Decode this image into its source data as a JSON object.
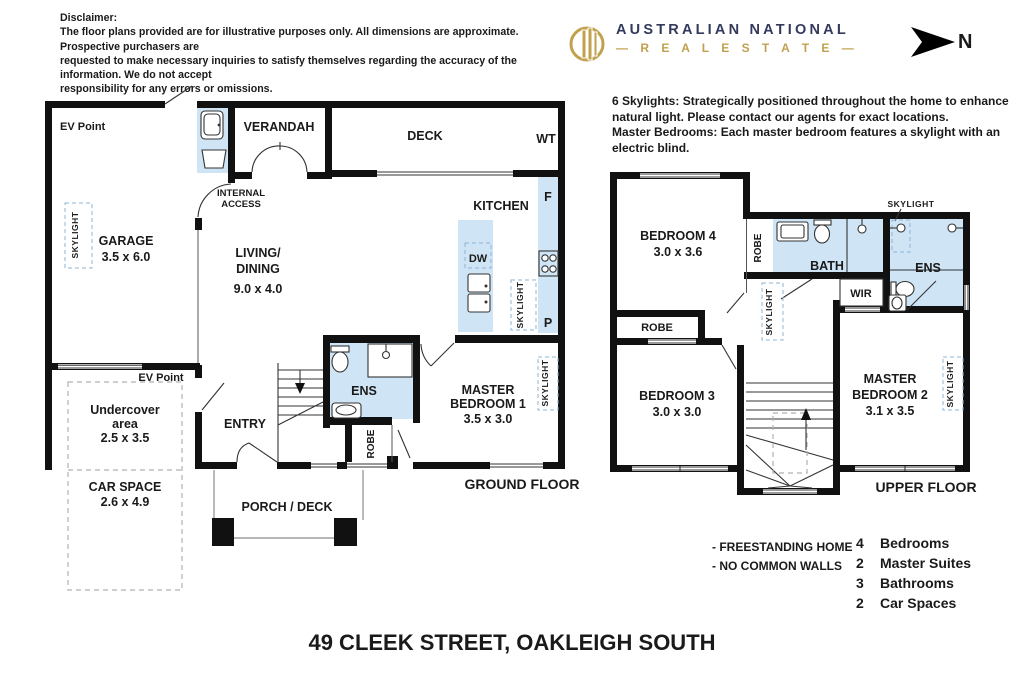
{
  "header": {
    "disclaimer_title": "Disclaimer:",
    "disclaimer_lines": [
      "The floor plans provided are for illustrative purposes only. All dimensions are approximate. Prospective purchasers are",
      "requested to make necessary inquiries to satisfy themselves regarding the accuracy of the information. We do not accept",
      "responsibility for any errors or omissions."
    ],
    "brand": {
      "name": "AUSTRALIAN NATIONAL",
      "tagline": "R E A L   E S T A T E",
      "dash": "—"
    },
    "north_label": "N"
  },
  "notes": {
    "skylights_1": "6 Skylights: Strategically positioned throughout the home to enhance",
    "skylights_2": "natural light. Please contact our agents for exact locations.",
    "skylights_3": "Master Bedrooms: Each master bedroom features a skylight with an",
    "skylights_4": "electric blind."
  },
  "labels": {
    "skylight": "SKYLIGHT",
    "robe": "ROBE",
    "ens": "ENS",
    "ev_point": "EV Point",
    "verandah": "VERANDAH",
    "deck": "DECK",
    "wt": "WT",
    "internal_access_1": "INTERNAL",
    "internal_access_2": "ACCESS",
    "kitchen": "KITCHEN",
    "fridge": "F",
    "pantry": "P",
    "dishwasher": "DW",
    "garage": "GARAGE",
    "garage_dims": "3.5 x 6.0",
    "living_1": "LIVING/",
    "living_2": "DINING",
    "living_dims": "9.0 x 4.0",
    "undercover_1": "Undercover",
    "undercover_2": "area",
    "undercover_dims": "2.5 x 3.5",
    "car_space": "CAR SPACE",
    "car_space_dims": "2.6 x 4.9",
    "entry": "ENTRY",
    "porch": "PORCH / DECK",
    "master1_1": "MASTER",
    "master1_2": "BEDROOM 1",
    "master1_dims": "3.5 x 3.0",
    "ground_floor": "GROUND FLOOR",
    "bedroom4": "BEDROOM 4",
    "bedroom4_dims": "3.0 x 3.6",
    "bedroom3": "BEDROOM 3",
    "bedroom3_dims": "3.0 x 3.0",
    "master2_1": "MASTER",
    "master2_2": "BEDROOM 2",
    "master2_dims": "3.1 x 3.5",
    "bath": "BATH",
    "wir": "WIR",
    "upper_floor": "UPPER FLOOR"
  },
  "footer": {
    "features": [
      "- FREESTANDING HOME",
      "- NO COMMON WALLS"
    ],
    "stats": [
      {
        "num": "4",
        "label": "Bedrooms"
      },
      {
        "num": "2",
        "label": "Master Suites"
      },
      {
        "num": "3",
        "label": "Bathrooms"
      },
      {
        "num": "2",
        "label": "Car Spaces"
      }
    ],
    "address": "49 CLEEK STREET, OAKLEIGH SOUTH"
  },
  "colors": {
    "room_fill": "#cfe5f5",
    "wall": "#111111",
    "brand_navy": "#333a5c",
    "brand_gold": "#c2a14e"
  }
}
